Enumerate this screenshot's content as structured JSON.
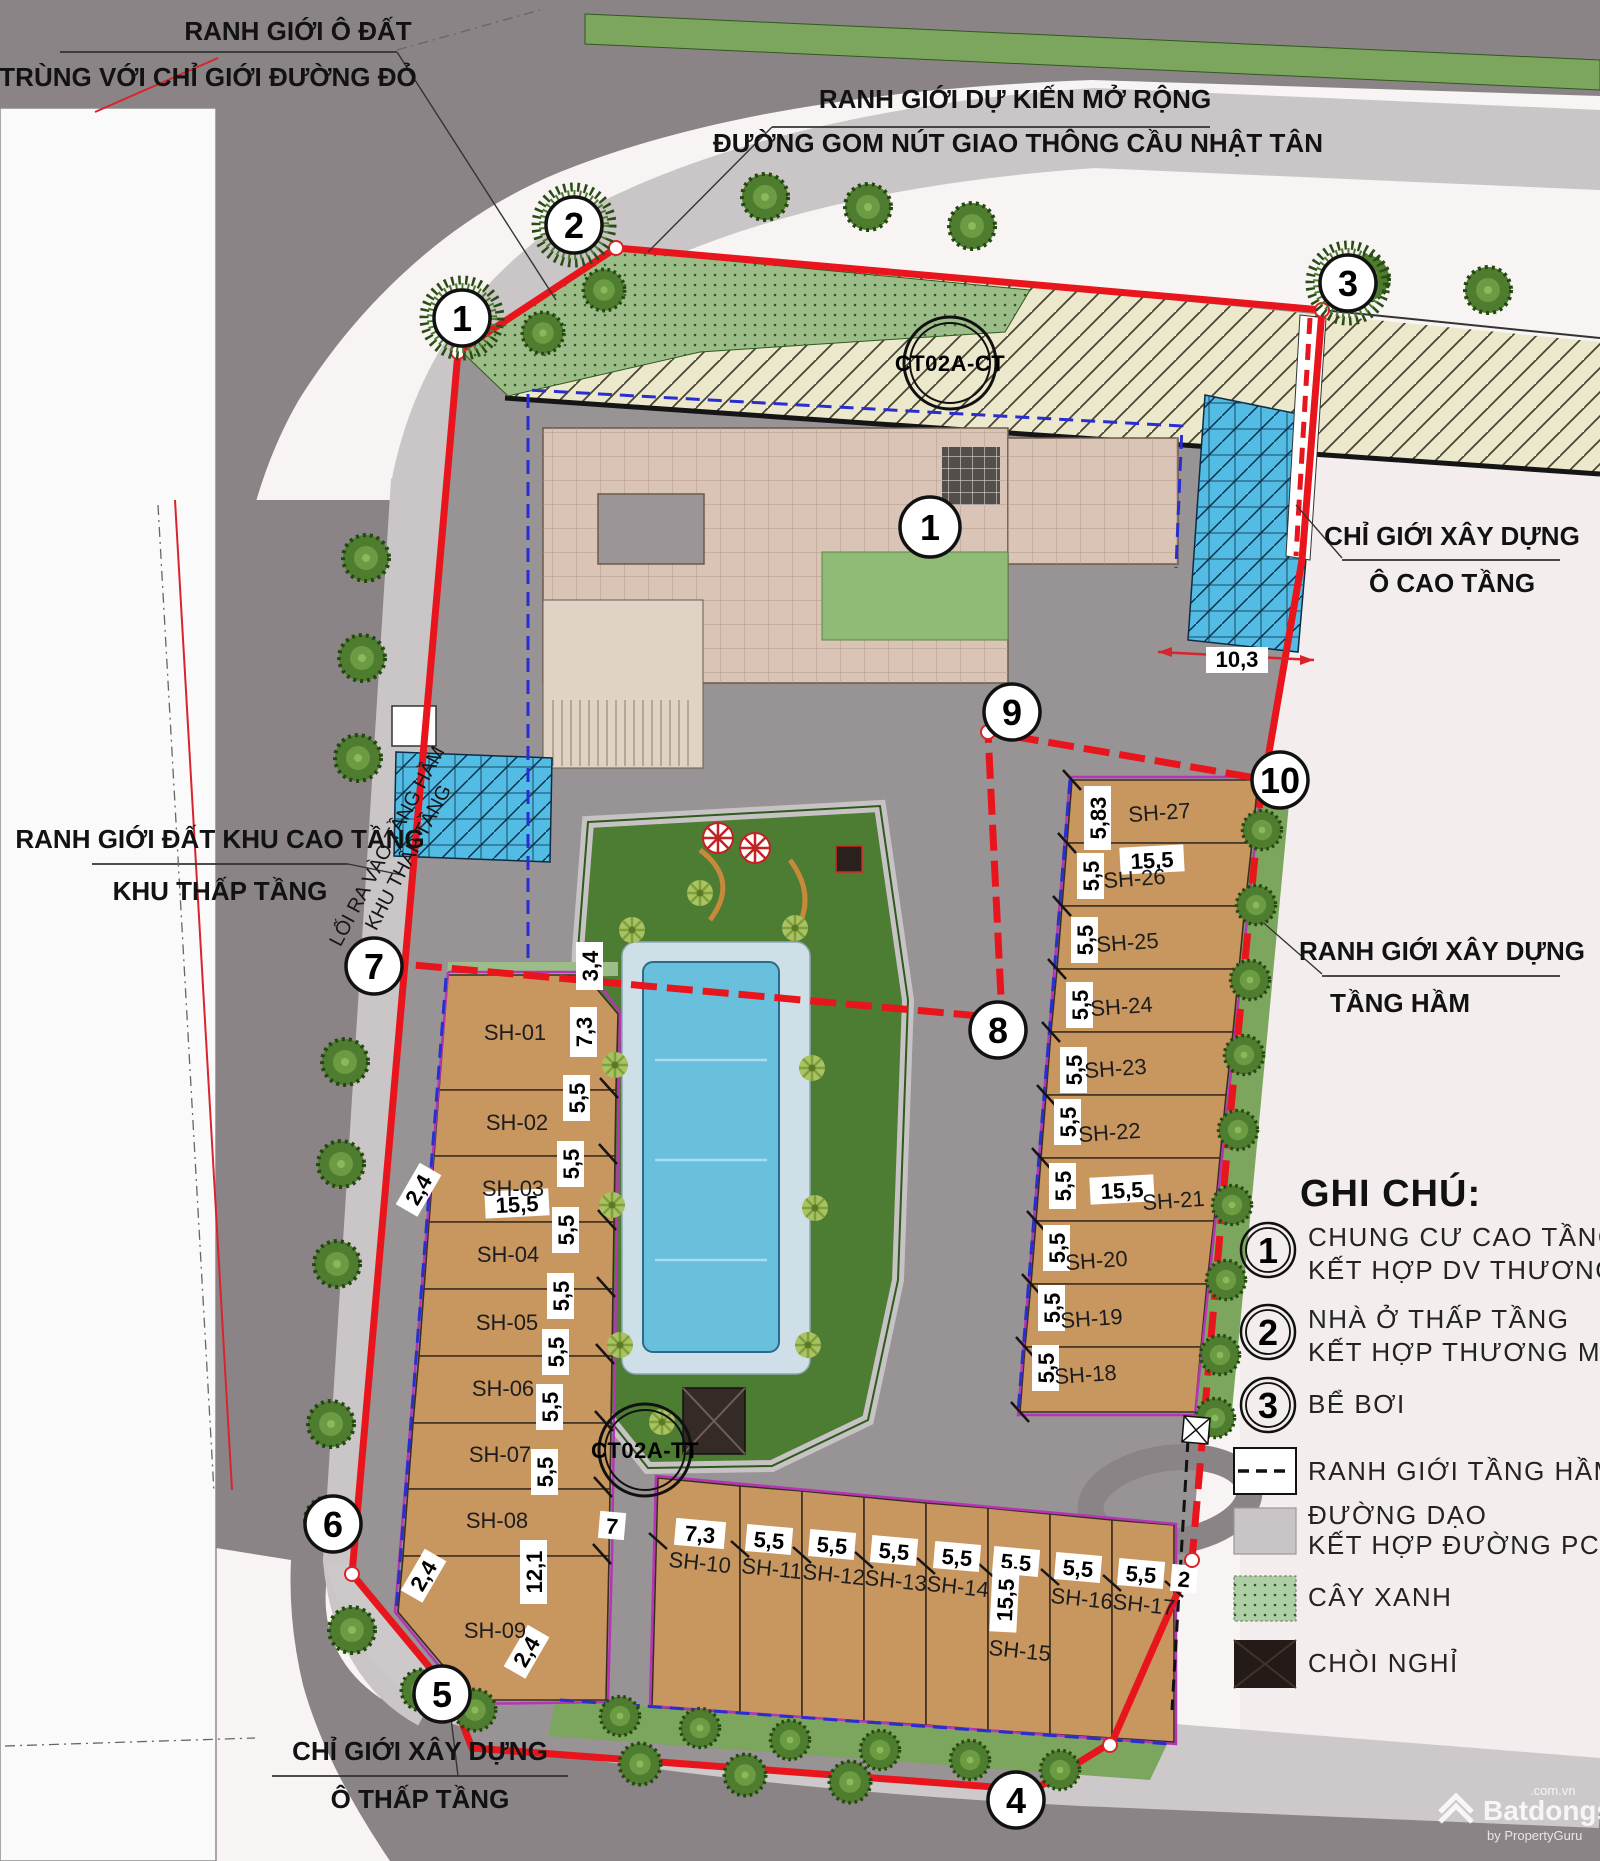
{
  "annotations": {
    "top_left": {
      "line1": "RANH GIỚI Ô ĐẤT",
      "line2": "TRÙNG VỚI CHỈ GIỚI ĐƯỜNG ĐỎ"
    },
    "top_center": {
      "line1": "RANH GIỚI DỰ KIẾN MỞ RỘNG",
      "line2": "ĐƯỜNG GOM NÚT GIAO THÔNG CẦU NHẬT TÂN"
    },
    "right_upper": {
      "line1": "CHỈ GIỚI XÂY DỰNG",
      "line2": "Ô CAO TẦNG"
    },
    "left_mid": {
      "line1": "RANH GIỚI ĐẤT KHU CAO TẦNG",
      "line2": "KHU THẤP TẦNG"
    },
    "right_mid": {
      "line1": "RANH GIỚI XÂY DỰNG",
      "line2": "TẦNG HẦM"
    },
    "bottom_left": {
      "line1": "CHỈ GIỚI XÂY DỰNG",
      "line2": "Ô THẤP TẦNG"
    },
    "ramp": {
      "line1": "LỐI RA VÀO TẦNG HẦM",
      "line2": "KHU THẤP TẦNG"
    }
  },
  "road_labels": {
    "ct": "CT02A-CT",
    "tt": "CT02A-TT"
  },
  "building_marker": "1",
  "boundary_points": [
    "1",
    "2",
    "3",
    "4",
    "5",
    "6",
    "7",
    "8",
    "9",
    "10"
  ],
  "lots": {
    "left": [
      {
        "id": "SH-01",
        "dim": "7,3"
      },
      {
        "id": "SH-02",
        "dim": "5,5"
      },
      {
        "id": "SH-03",
        "dim": "5,5"
      },
      {
        "id": "SH-04",
        "dim": "5,5"
      },
      {
        "id": "SH-05",
        "dim": "5,5"
      },
      {
        "id": "SH-06",
        "dim": "5,5"
      },
      {
        "id": "SH-07",
        "dim": "5,5"
      },
      {
        "id": "SH-08",
        "dim": "5,5"
      },
      {
        "id": "SH-09",
        "dim": "12,1"
      }
    ],
    "right": [
      {
        "id": "SH-27",
        "dim": "5,83"
      },
      {
        "id": "SH-26",
        "dim": "5,5"
      },
      {
        "id": "SH-25",
        "dim": "5,5"
      },
      {
        "id": "SH-24",
        "dim": "5,5"
      },
      {
        "id": "SH-23",
        "dim": "5,5"
      },
      {
        "id": "SH-22",
        "dim": "5,5"
      },
      {
        "id": "SH-21",
        "dim": "5,5"
      },
      {
        "id": "SH-20",
        "dim": "5,5"
      },
      {
        "id": "SH-19",
        "dim": "5,5"
      },
      {
        "id": "SH-18",
        "dim": "5,5"
      }
    ],
    "bottom": [
      {
        "id": "SH-10",
        "dim": "7,3"
      },
      {
        "id": "SH-11",
        "dim": "5,5"
      },
      {
        "id": "SH-12",
        "dim": "5,5"
      },
      {
        "id": "SH-13",
        "dim": "5,5"
      },
      {
        "id": "SH-14",
        "dim": "5,5"
      },
      {
        "id": "SH-15",
        "dim": "5,5"
      },
      {
        "id": "SH-16",
        "dim": "5,5"
      },
      {
        "id": "SH-17",
        "dim": "5,5"
      }
    ]
  },
  "extra_dims": {
    "d34": "3,4",
    "w155": "15,5",
    "d24": "2,4",
    "d103": "10,3",
    "d7": "7",
    "d2": "2"
  },
  "legend": {
    "title": "GHI CHÚ:",
    "items": [
      {
        "num": "1",
        "line1": "CHUNG CƯ CAO TẦNG",
        "line2": "KẾT HỢP DV THƯƠNG MẠI"
      },
      {
        "num": "2",
        "line1": "NHÀ Ở THẤP TẦNG",
        "line2": "KẾT HỢP THƯƠNG MẠI"
      },
      {
        "num": "3",
        "line1": "BỂ BƠI",
        "line2": ""
      }
    ],
    "swatches": [
      {
        "label1": "RANH GIỚI TẦNG HẦM",
        "label2": ""
      },
      {
        "label1": "ĐƯỜNG DẠO",
        "label2": "KẾT HỢP ĐƯỜNG PCCC"
      },
      {
        "label1": "CÂY XANH",
        "label2": ""
      },
      {
        "label1": "CHÒI NGHỈ",
        "label2": ""
      }
    ]
  },
  "watermark": {
    "brand": "Batdongsan",
    "tld": ".com.vn",
    "by": "by PropertyGuru"
  },
  "colors": {
    "boundary_red": "#e8151d",
    "lot_line_magenta": "#b535b5",
    "basement_navy": "#2a2ed0",
    "lot_tan": "#c8965f",
    "glass_blue": "#52bce4",
    "park_green": "#4d7c33",
    "pool_blue": "#68c0dd"
  }
}
